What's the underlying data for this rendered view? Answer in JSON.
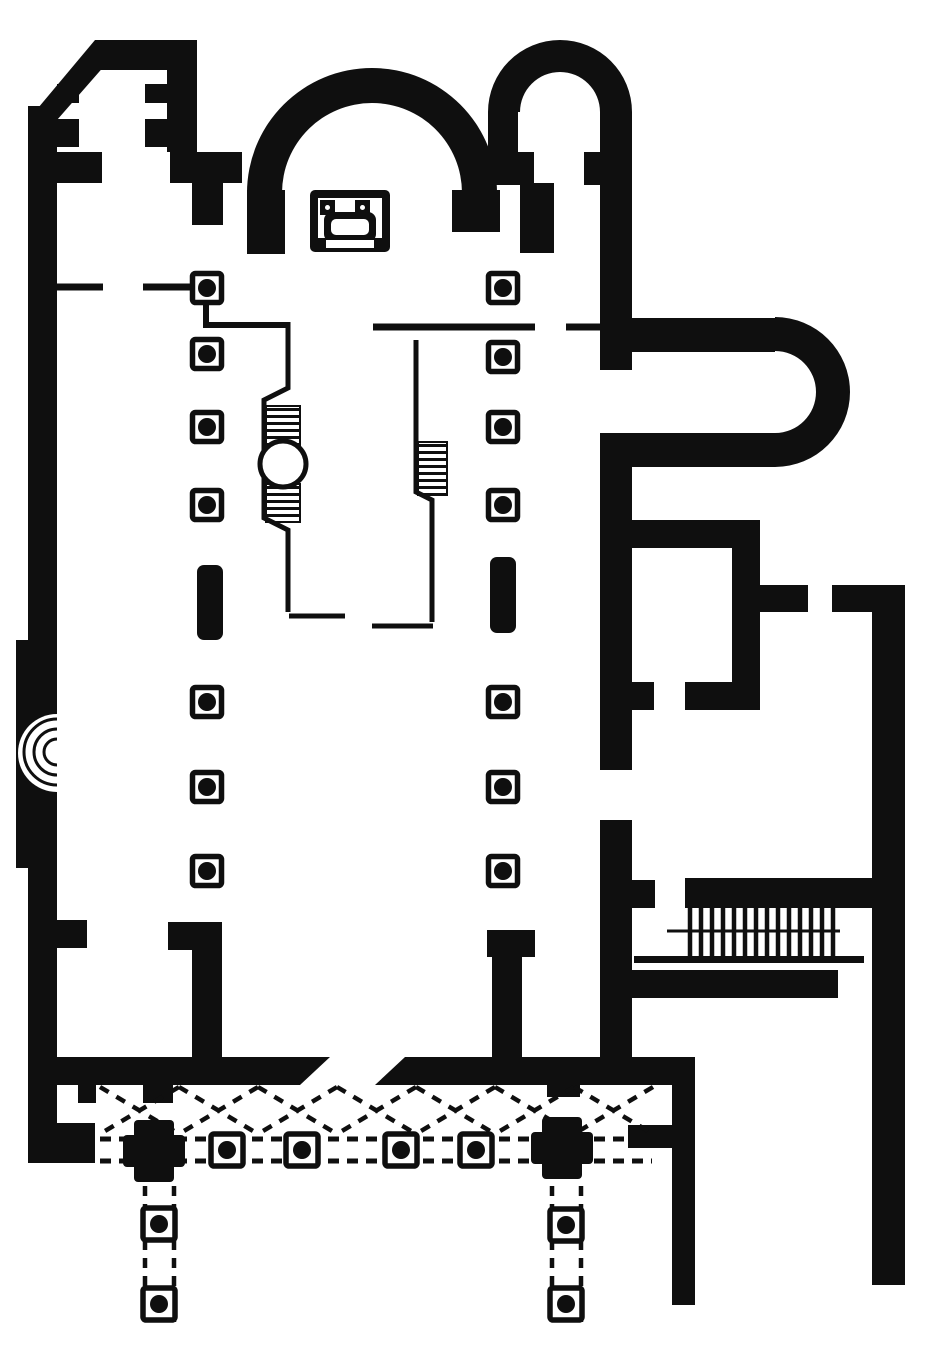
{
  "canvas": {
    "width": 926,
    "height": 1350,
    "background": "#ffffff",
    "ink": "#0f0f0f"
  },
  "plan": {
    "description_names": {
      "drawing": "church-basilica-floor-plan",
      "regions": [
        "nw-tower",
        "main-apse",
        "ne-tower",
        "nave",
        "chancel-enclosure",
        "ambo",
        "altar-ciborium",
        "east-exedra",
        "side-room",
        "staircase",
        "atrium-portico",
        "south-corridors"
      ]
    },
    "shapes": [
      {
        "t": "prect",
        "n": "west-outer-wall",
        "x": 28,
        "y": 106,
        "w": 29,
        "h": 1057
      },
      {
        "t": "ppoly",
        "n": "nw-diagonal-wall",
        "pts": "95,40 127,40 57,120 28,120"
      },
      {
        "t": "prect",
        "n": "nw-tower-north-wall",
        "x": 95,
        "y": 40,
        "w": 102,
        "h": 30
      },
      {
        "t": "prect",
        "n": "nw-tower-east-wall",
        "x": 167,
        "y": 66,
        "w": 30,
        "h": 86
      },
      {
        "t": "prect",
        "n": "nw-tower-pilaster-w1",
        "x": 57,
        "y": 84,
        "w": 22,
        "h": 19
      },
      {
        "t": "prect",
        "n": "nw-tower-pilaster-w2",
        "x": 57,
        "y": 119,
        "w": 22,
        "h": 28
      },
      {
        "t": "prect",
        "n": "nw-tower-pilaster-e1",
        "x": 145,
        "y": 84,
        "w": 22,
        "h": 19
      },
      {
        "t": "prect",
        "n": "nw-tower-pilaster-e2",
        "x": 145,
        "y": 119,
        "w": 22,
        "h": 28
      },
      {
        "t": "prect",
        "n": "west-door-pier",
        "x": 57,
        "y": 152,
        "w": 45,
        "h": 31
      },
      {
        "t": "prect",
        "n": "nw-crossing-pier-h",
        "x": 170,
        "y": 152,
        "w": 72,
        "h": 31
      },
      {
        "t": "prect",
        "n": "nw-crossing-pier-v",
        "x": 192,
        "y": 152,
        "w": 31,
        "h": 73
      },
      {
        "t": "ppath",
        "n": "main-apse-wall",
        "d": "M247,193 A125,125 0 0 1 497,193 L462,193 A90,90 0 0 0 282,193 Z"
      },
      {
        "t": "prect",
        "n": "apse-west-springer",
        "x": 247,
        "y": 190,
        "w": 38,
        "h": 64
      },
      {
        "t": "prect",
        "n": "apse-east-springer",
        "x": 452,
        "y": 190,
        "w": 48,
        "h": 42
      },
      {
        "t": "prect",
        "n": "ne-hanging-pier",
        "x": 520,
        "y": 183,
        "w": 34,
        "h": 70
      },
      {
        "t": "ppath",
        "n": "ne-tower-arch-wall",
        "d": "M488,112 A72,72 0 0 1 632,112 L600,112 A40,40 0 0 0 520,112 Z"
      },
      {
        "t": "prect",
        "n": "ne-tower-west-wall",
        "x": 488,
        "y": 112,
        "w": 30,
        "h": 73
      },
      {
        "t": "prect",
        "n": "ne-tower-stub-w",
        "x": 518,
        "y": 152,
        "w": 16,
        "h": 33
      },
      {
        "t": "prect",
        "n": "ne-tower-stub-e",
        "x": 584,
        "y": 152,
        "w": 16,
        "h": 33
      },
      {
        "t": "prect",
        "n": "east-wall-upper",
        "x": 600,
        "y": 112,
        "w": 32,
        "h": 258
      },
      {
        "t": "prect",
        "n": "east-wall-middle",
        "x": 600,
        "y": 433,
        "w": 32,
        "h": 337
      },
      {
        "t": "prect",
        "n": "east-wall-lower",
        "x": 600,
        "y": 820,
        "w": 32,
        "h": 263
      },
      {
        "t": "prect",
        "n": "exedra-north-arm",
        "x": 632,
        "y": 318,
        "w": 143,
        "h": 34
      },
      {
        "t": "prect",
        "n": "exedra-south-arm",
        "x": 632,
        "y": 433,
        "w": 143,
        "h": 34
      },
      {
        "t": "ppath",
        "n": "exedra-apse-wall",
        "d": "M775,317 A75,75 0 0 1 775,467 L775,433 A41,41 0 0 0 775,351 Z"
      },
      {
        "t": "prect",
        "n": "side-room-north-wall",
        "x": 632,
        "y": 520,
        "w": 128,
        "h": 28
      },
      {
        "t": "prect",
        "n": "side-room-east-wall",
        "x": 732,
        "y": 548,
        "w": 28,
        "h": 162
      },
      {
        "t": "prect",
        "n": "side-room-east-stub",
        "x": 760,
        "y": 585,
        "w": 48,
        "h": 27
      },
      {
        "t": "prect",
        "n": "side-room-south-wall",
        "x": 685,
        "y": 682,
        "w": 75,
        "h": 28
      },
      {
        "t": "prect",
        "n": "side-room-west-stub",
        "x": 632,
        "y": 682,
        "w": 22,
        "h": 28
      },
      {
        "t": "prect",
        "n": "outer-wall-north-arm",
        "x": 832,
        "y": 585,
        "w": 73,
        "h": 27
      },
      {
        "t": "prect",
        "n": "east-outer-wall",
        "x": 872,
        "y": 585,
        "w": 33,
        "h": 700
      },
      {
        "t": "prect",
        "n": "stair-hall-west-stub",
        "x": 632,
        "y": 880,
        "w": 23,
        "h": 28
      },
      {
        "t": "prect",
        "n": "stair-north-band",
        "x": 685,
        "y": 878,
        "w": 190,
        "h": 30
      },
      {
        "t": "prect",
        "n": "stair-south-band",
        "x": 632,
        "y": 970,
        "w": 206,
        "h": 28
      },
      {
        "t": "prect",
        "n": "under-stair-sill",
        "x": 634,
        "y": 956,
        "w": 230,
        "h": 7
      },
      {
        "t": "prect",
        "n": "nave-sw-return-head",
        "x": 168,
        "y": 922,
        "w": 24,
        "h": 28
      },
      {
        "t": "prect",
        "n": "nave-sw-return-wall",
        "x": 192,
        "y": 922,
        "w": 30,
        "h": 135
      },
      {
        "t": "prect",
        "n": "nave-se-return-head",
        "x": 487,
        "y": 930,
        "w": 48,
        "h": 27
      },
      {
        "t": "prect",
        "n": "nave-se-return-wall",
        "x": 492,
        "y": 957,
        "w": 30,
        "h": 100
      },
      {
        "t": "prect",
        "n": "west-wall-south-stub",
        "x": 57,
        "y": 920,
        "w": 30,
        "h": 28
      },
      {
        "t": "prect",
        "n": "west-wall-pilaster",
        "x": 16,
        "y": 640,
        "w": 12,
        "h": 228
      },
      {
        "t": "prect",
        "n": "sw-corner-foot",
        "x": 57,
        "y": 1123,
        "w": 38,
        "h": 40
      },
      {
        "t": "ppoly",
        "n": "atrium-north-wall-west",
        "pts": "38,1057 330,1057 300,1085 38,1085"
      },
      {
        "t": "ppoly",
        "n": "atrium-north-wall-east",
        "pts": "405,1057 695,1057 695,1085 375,1085"
      },
      {
        "t": "prect",
        "n": "portico-respond-1",
        "x": 78,
        "y": 1085,
        "w": 18,
        "h": 18
      },
      {
        "t": "prect",
        "n": "portico-respond-2",
        "x": 143,
        "y": 1085,
        "w": 30,
        "h": 18
      },
      {
        "t": "prect",
        "n": "portico-respond-3",
        "x": 547,
        "y": 1085,
        "w": 33,
        "h": 12
      },
      {
        "t": "prect",
        "n": "portico-east-connector",
        "x": 628,
        "y": 1125,
        "w": 44,
        "h": 23
      },
      {
        "t": "prect",
        "n": "atrium-east-wall",
        "x": 672,
        "y": 1085,
        "w": 23,
        "h": 220
      },
      {
        "t": "wrect",
        "n": "ne-tower-inner-void",
        "x": 520,
        "y": 112,
        "w": 80,
        "h": 40
      },
      {
        "t": "wpath",
        "n": "west-niche-fan",
        "d": "M57,714 A39,39 0 0 0 57,792 Z"
      },
      {
        "t": "line",
        "n": "west-niche-step-1",
        "d": "M57,739 A13,13 0 0 0 57,765",
        "w": 3
      },
      {
        "t": "line",
        "n": "west-niche-step-2",
        "d": "M57,729 A23,23 0 0 0 57,775",
        "w": 3
      },
      {
        "t": "line",
        "n": "west-niche-step-3",
        "d": "M57,719 A33,33 0 0 0 57,785",
        "w": 3
      },
      {
        "t": "line",
        "n": "north-rail-w1",
        "d": "M57,287 L103,287",
        "w": 7
      },
      {
        "t": "line",
        "n": "north-rail-w2",
        "d": "M143,287 L194,287",
        "w": 7
      },
      {
        "t": "line",
        "n": "screen-link-vertical",
        "d": "M206,301 L206,323",
        "w": 6
      },
      {
        "t": "line",
        "n": "transverse-rail-west",
        "d": "M203,325 L288,325",
        "w": 6
      },
      {
        "t": "line",
        "n": "transverse-rail-mid",
        "d": "M373,327 L535,327",
        "w": 7
      },
      {
        "t": "line",
        "n": "transverse-rail-east",
        "d": "M566,327 L600,327",
        "w": 7
      },
      {
        "t": "line",
        "n": "chancel-screen-west",
        "d": "M288,322 L288,388 L264,400 L264,518 L288,530 L288,612",
        "w": 5
      },
      {
        "t": "line",
        "n": "chancel-screen-west-foot",
        "d": "M289,616 L345,616",
        "w": 5
      },
      {
        "t": "line",
        "n": "chancel-screen-east",
        "d": "M416,340 L416,492 L432,500 L432,622",
        "w": 5
      },
      {
        "t": "line",
        "n": "chancel-screen-east-foot",
        "d": "M372,626 L433,626",
        "w": 5
      },
      {
        "t": "hatch",
        "n": "ambo-north-steps",
        "x": 266,
        "y": 406,
        "w": 34,
        "h": 40,
        "gap": 7,
        "lw": 3
      },
      {
        "t": "hatch",
        "n": "ambo-south-steps",
        "x": 266,
        "y": 484,
        "w": 34,
        "h": 38,
        "gap": 7,
        "lw": 3
      },
      {
        "t": "hatch",
        "n": "bema-steps",
        "x": 418,
        "y": 442,
        "w": 29,
        "h": 53,
        "gap": 7,
        "lw": 3
      },
      {
        "t": "circle",
        "n": "ambo-platform",
        "cx": 283,
        "cy": 464,
        "r": 23,
        "sw": 5,
        "f": "bg"
      },
      {
        "t": "vlines",
        "n": "staircase-treads",
        "x0": 690,
        "step": 11,
        "nn": 14,
        "y1": 906,
        "y2": 958,
        "w": 4.5
      },
      {
        "t": "line",
        "n": "stair-mid-rail",
        "d": "M667,931 L840,931",
        "w": 3
      },
      {
        "t": "pier",
        "n": "nave-pier-w1",
        "cx": 207,
        "cy": 288,
        "s": 29,
        "dot": 9
      },
      {
        "t": "pier",
        "n": "nave-pier-w2",
        "cx": 207,
        "cy": 354,
        "s": 29,
        "dot": 9
      },
      {
        "t": "pier",
        "n": "nave-pier-w3",
        "cx": 207,
        "cy": 427,
        "s": 29,
        "dot": 9
      },
      {
        "t": "pier",
        "n": "nave-pier-w4",
        "cx": 207,
        "cy": 505,
        "s": 29,
        "dot": 9
      },
      {
        "t": "pier",
        "n": "nave-pier-w5",
        "cx": 207,
        "cy": 702,
        "s": 29,
        "dot": 9
      },
      {
        "t": "pier",
        "n": "nave-pier-w6",
        "cx": 207,
        "cy": 787,
        "s": 29,
        "dot": 9
      },
      {
        "t": "pier",
        "n": "nave-pier-w7",
        "cx": 207,
        "cy": 871,
        "s": 29,
        "dot": 9
      },
      {
        "t": "pier",
        "n": "nave-pier-e1",
        "cx": 503,
        "cy": 288,
        "s": 29,
        "dot": 9
      },
      {
        "t": "pier",
        "n": "nave-pier-e2",
        "cx": 503,
        "cy": 357,
        "s": 29,
        "dot": 9
      },
      {
        "t": "pier",
        "n": "nave-pier-e3",
        "cx": 503,
        "cy": 427,
        "s": 29,
        "dot": 9
      },
      {
        "t": "pier",
        "n": "nave-pier-e4",
        "cx": 503,
        "cy": 505,
        "s": 29,
        "dot": 9
      },
      {
        "t": "pier",
        "n": "nave-pier-e5",
        "cx": 503,
        "cy": 702,
        "s": 29,
        "dot": 9
      },
      {
        "t": "pier",
        "n": "nave-pier-e6",
        "cx": 503,
        "cy": 787,
        "s": 29,
        "dot": 9
      },
      {
        "t": "pier",
        "n": "nave-pier-e7",
        "cx": 503,
        "cy": 871,
        "s": 29,
        "dot": 9
      },
      {
        "t": "bar",
        "n": "nave-solid-pier-west",
        "x": 197,
        "y": 565,
        "w": 26,
        "h": 75,
        "rx": 7
      },
      {
        "t": "bar",
        "n": "nave-solid-pier-east",
        "x": 490,
        "y": 557,
        "w": 26,
        "h": 76,
        "rx": 7
      },
      {
        "t": "line",
        "n": "stylobate-dashed-north",
        "d": "M100,1139 L652,1139",
        "w": 5,
        "dash": "11 8"
      },
      {
        "t": "line",
        "n": "stylobate-dashed-south",
        "d": "M100,1161 L652,1161",
        "w": 5,
        "dash": "11 8"
      },
      {
        "t": "xrow",
        "n": "portico-vault-braces",
        "x0": 100,
        "cell": 79,
        "nn": 7,
        "y1": 1087,
        "y2": 1134,
        "w": 4.5,
        "dash": "10 9"
      },
      {
        "t": "prect",
        "n": "atrium-cross-pier-west-v",
        "x": 134,
        "y": 1120,
        "w": 40,
        "h": 62,
        "rx": 4
      },
      {
        "t": "prect",
        "n": "atrium-cross-pier-west-h",
        "x": 123,
        "y": 1135,
        "w": 62,
        "h": 32,
        "rx": 4
      },
      {
        "t": "prect",
        "n": "atrium-cross-pier-east-v",
        "x": 542,
        "y": 1117,
        "w": 40,
        "h": 62,
        "rx": 4
      },
      {
        "t": "prect",
        "n": "atrium-cross-pier-east-h",
        "x": 531,
        "y": 1132,
        "w": 62,
        "h": 32,
        "rx": 4
      },
      {
        "t": "pier",
        "n": "atrium-pier-1",
        "cx": 227,
        "cy": 1150,
        "s": 32,
        "dot": 9
      },
      {
        "t": "pier",
        "n": "atrium-pier-2",
        "cx": 302,
        "cy": 1150,
        "s": 32,
        "dot": 9
      },
      {
        "t": "pier",
        "n": "atrium-pier-3",
        "cx": 401,
        "cy": 1150,
        "s": 32,
        "dot": 9
      },
      {
        "t": "pier",
        "n": "atrium-pier-4",
        "cx": 476,
        "cy": 1150,
        "s": 32,
        "dot": 9
      },
      {
        "t": "line",
        "n": "south-corridor-west-l",
        "d": "M145,1186 L145,1322",
        "w": 4.5,
        "dash": "10 8"
      },
      {
        "t": "line",
        "n": "south-corridor-west-r",
        "d": "M174,1186 L174,1322",
        "w": 4.5,
        "dash": "10 8"
      },
      {
        "t": "line",
        "n": "south-corridor-east-l",
        "d": "M552,1186 L552,1322",
        "w": 4.5,
        "dash": "10 8"
      },
      {
        "t": "line",
        "n": "south-corridor-east-r",
        "d": "M581,1186 L581,1322",
        "w": 4.5,
        "dash": "10 8"
      },
      {
        "t": "pier",
        "n": "south-pier-w1",
        "cx": 159,
        "cy": 1224,
        "s": 32,
        "dot": 9
      },
      {
        "t": "pier",
        "n": "south-pier-w2",
        "cx": 159,
        "cy": 1304,
        "s": 32,
        "dot": 9
      },
      {
        "t": "pier",
        "n": "south-pier-e1",
        "cx": 566,
        "cy": 1225,
        "s": 32,
        "dot": 9
      },
      {
        "t": "pier",
        "n": "south-pier-e2",
        "cx": 566,
        "cy": 1304,
        "s": 32,
        "dot": 9
      },
      {
        "t": "prect",
        "n": "altar-frame",
        "x": 310,
        "y": 190,
        "w": 80,
        "h": 62,
        "rx": 5
      },
      {
        "t": "wrect",
        "n": "altar-inner-void",
        "x": 318,
        "y": 198,
        "w": 64,
        "h": 40
      },
      {
        "t": "prect",
        "n": "altar-post-nw",
        "x": 320,
        "y": 200,
        "w": 15,
        "h": 15
      },
      {
        "t": "prect",
        "n": "altar-post-ne",
        "x": 355,
        "y": 200,
        "w": 15,
        "h": 15
      },
      {
        "t": "circle",
        "n": "altar-post-nw-dot",
        "cx": 327.5,
        "cy": 207.5,
        "r": 2.5,
        "sw": 0,
        "f": "bg"
      },
      {
        "t": "circle",
        "n": "altar-post-ne-dot",
        "cx": 362.5,
        "cy": 207.5,
        "r": 2.5,
        "sw": 0,
        "f": "bg"
      },
      {
        "t": "prect",
        "n": "altar-table-frame",
        "x": 324,
        "y": 212,
        "w": 52,
        "h": 30,
        "rx": 8
      },
      {
        "t": "wrect",
        "n": "altar-table-top",
        "x": 331,
        "y": 219,
        "w": 38,
        "h": 16,
        "rx": 5
      },
      {
        "t": "wrect",
        "n": "altar-step-slot",
        "x": 326,
        "y": 240,
        "w": 48,
        "h": 8
      }
    ]
  }
}
